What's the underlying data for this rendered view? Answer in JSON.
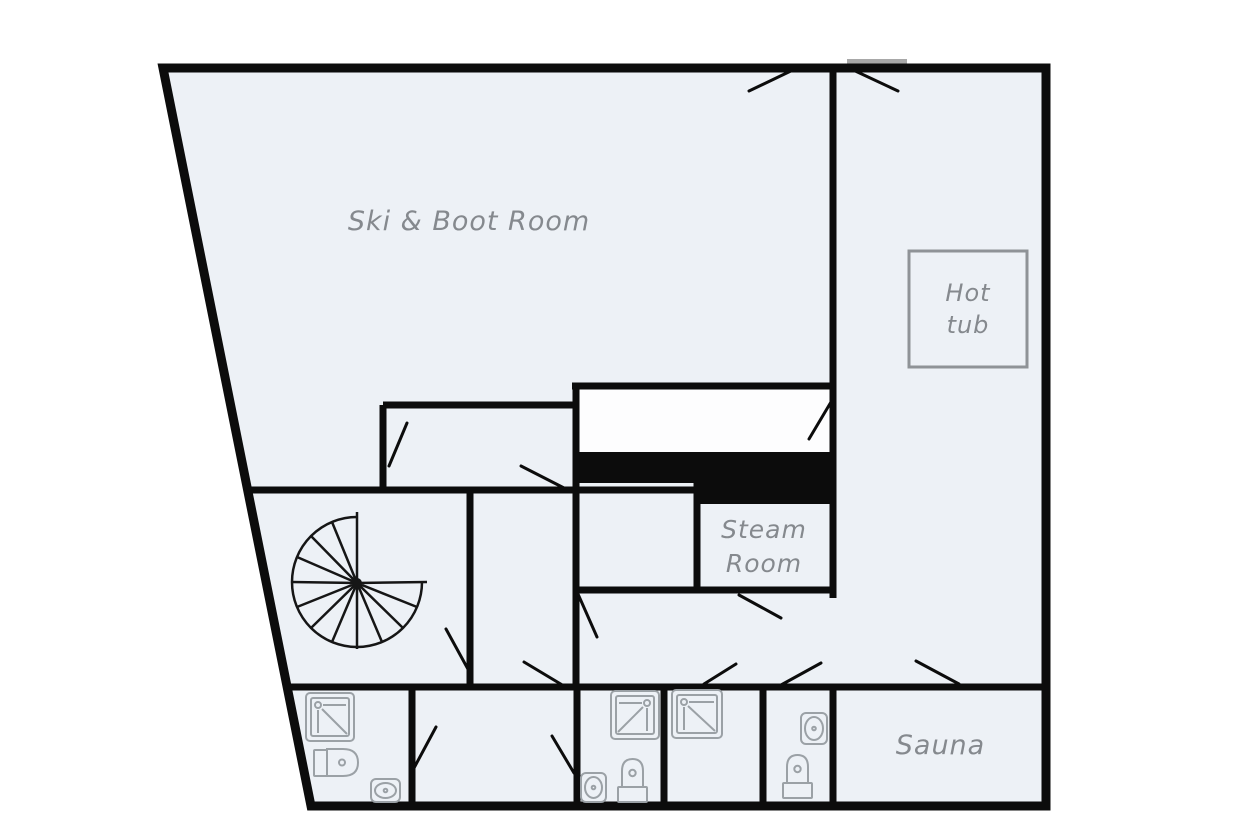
{
  "plan": {
    "type": "floor-plan",
    "labels": {
      "ski_boot_room": "Ski & Boot Room",
      "hot_tub_line1": "Hot",
      "hot_tub_line2": "tub",
      "steam_room_line1": "Steam",
      "steam_room_line2": "Room",
      "sauna": "Sauna"
    },
    "rooms": [
      {
        "name": "Ski & Boot Room",
        "position": "top-left",
        "fixtures": []
      },
      {
        "name": "Hot tub area",
        "position": "right",
        "fixtures": [
          "hot-tub"
        ]
      },
      {
        "name": "Steam Room",
        "position": "center-right",
        "fixtures": []
      },
      {
        "name": "Sauna",
        "position": "bottom-right",
        "fixtures": []
      },
      {
        "name": "Stair room",
        "position": "center-left",
        "fixtures": [
          "spiral-staircase"
        ]
      },
      {
        "name": "Bathroom 1",
        "position": "bottom-left",
        "fixtures": [
          "shower",
          "toilet",
          "sink"
        ]
      },
      {
        "name": "Room 2",
        "position": "bottom",
        "fixtures": []
      },
      {
        "name": "Bathroom 3",
        "position": "bottom",
        "fixtures": [
          "shower",
          "toilet",
          "sink"
        ]
      },
      {
        "name": "Shower room 4",
        "position": "bottom",
        "fixtures": [
          "shower"
        ]
      },
      {
        "name": "WC 5",
        "position": "bottom",
        "fixtures": [
          "toilet",
          "sink"
        ]
      }
    ]
  },
  "colors": {
    "floor": "#edf1f6",
    "wall": "#0c0c0c",
    "label": "#85898e",
    "fixture": "#9ba1a6",
    "hot_tub_outline": "#8f9397",
    "closet": "#fdfdfe",
    "door_opening": "#a8a8a8",
    "background": "#ffffff"
  }
}
